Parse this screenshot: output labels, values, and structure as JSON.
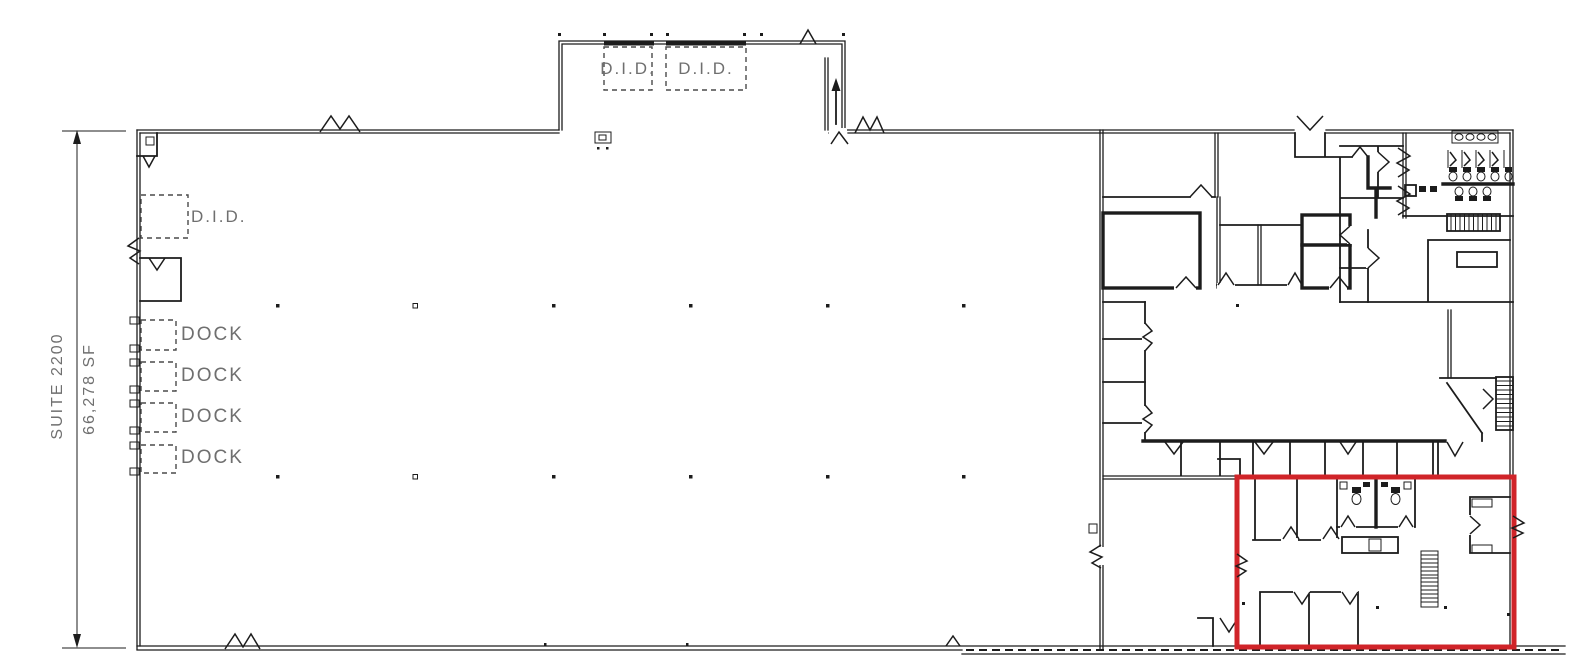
{
  "colors": {
    "wall": "#1c1c1c",
    "label_text": "#6f6f6f",
    "highlight": "#d02429",
    "background": "#ffffff"
  },
  "labels": {
    "suite": "SUITE 2200",
    "area": "66,278 SF",
    "did_side": "D.I.D.",
    "did_top_1": "D.I.D.",
    "did_top_2": "D.I.D.",
    "dock_1": "DOCK",
    "dock_2": "DOCK",
    "dock_3": "DOCK",
    "dock_4": "DOCK"
  }
}
